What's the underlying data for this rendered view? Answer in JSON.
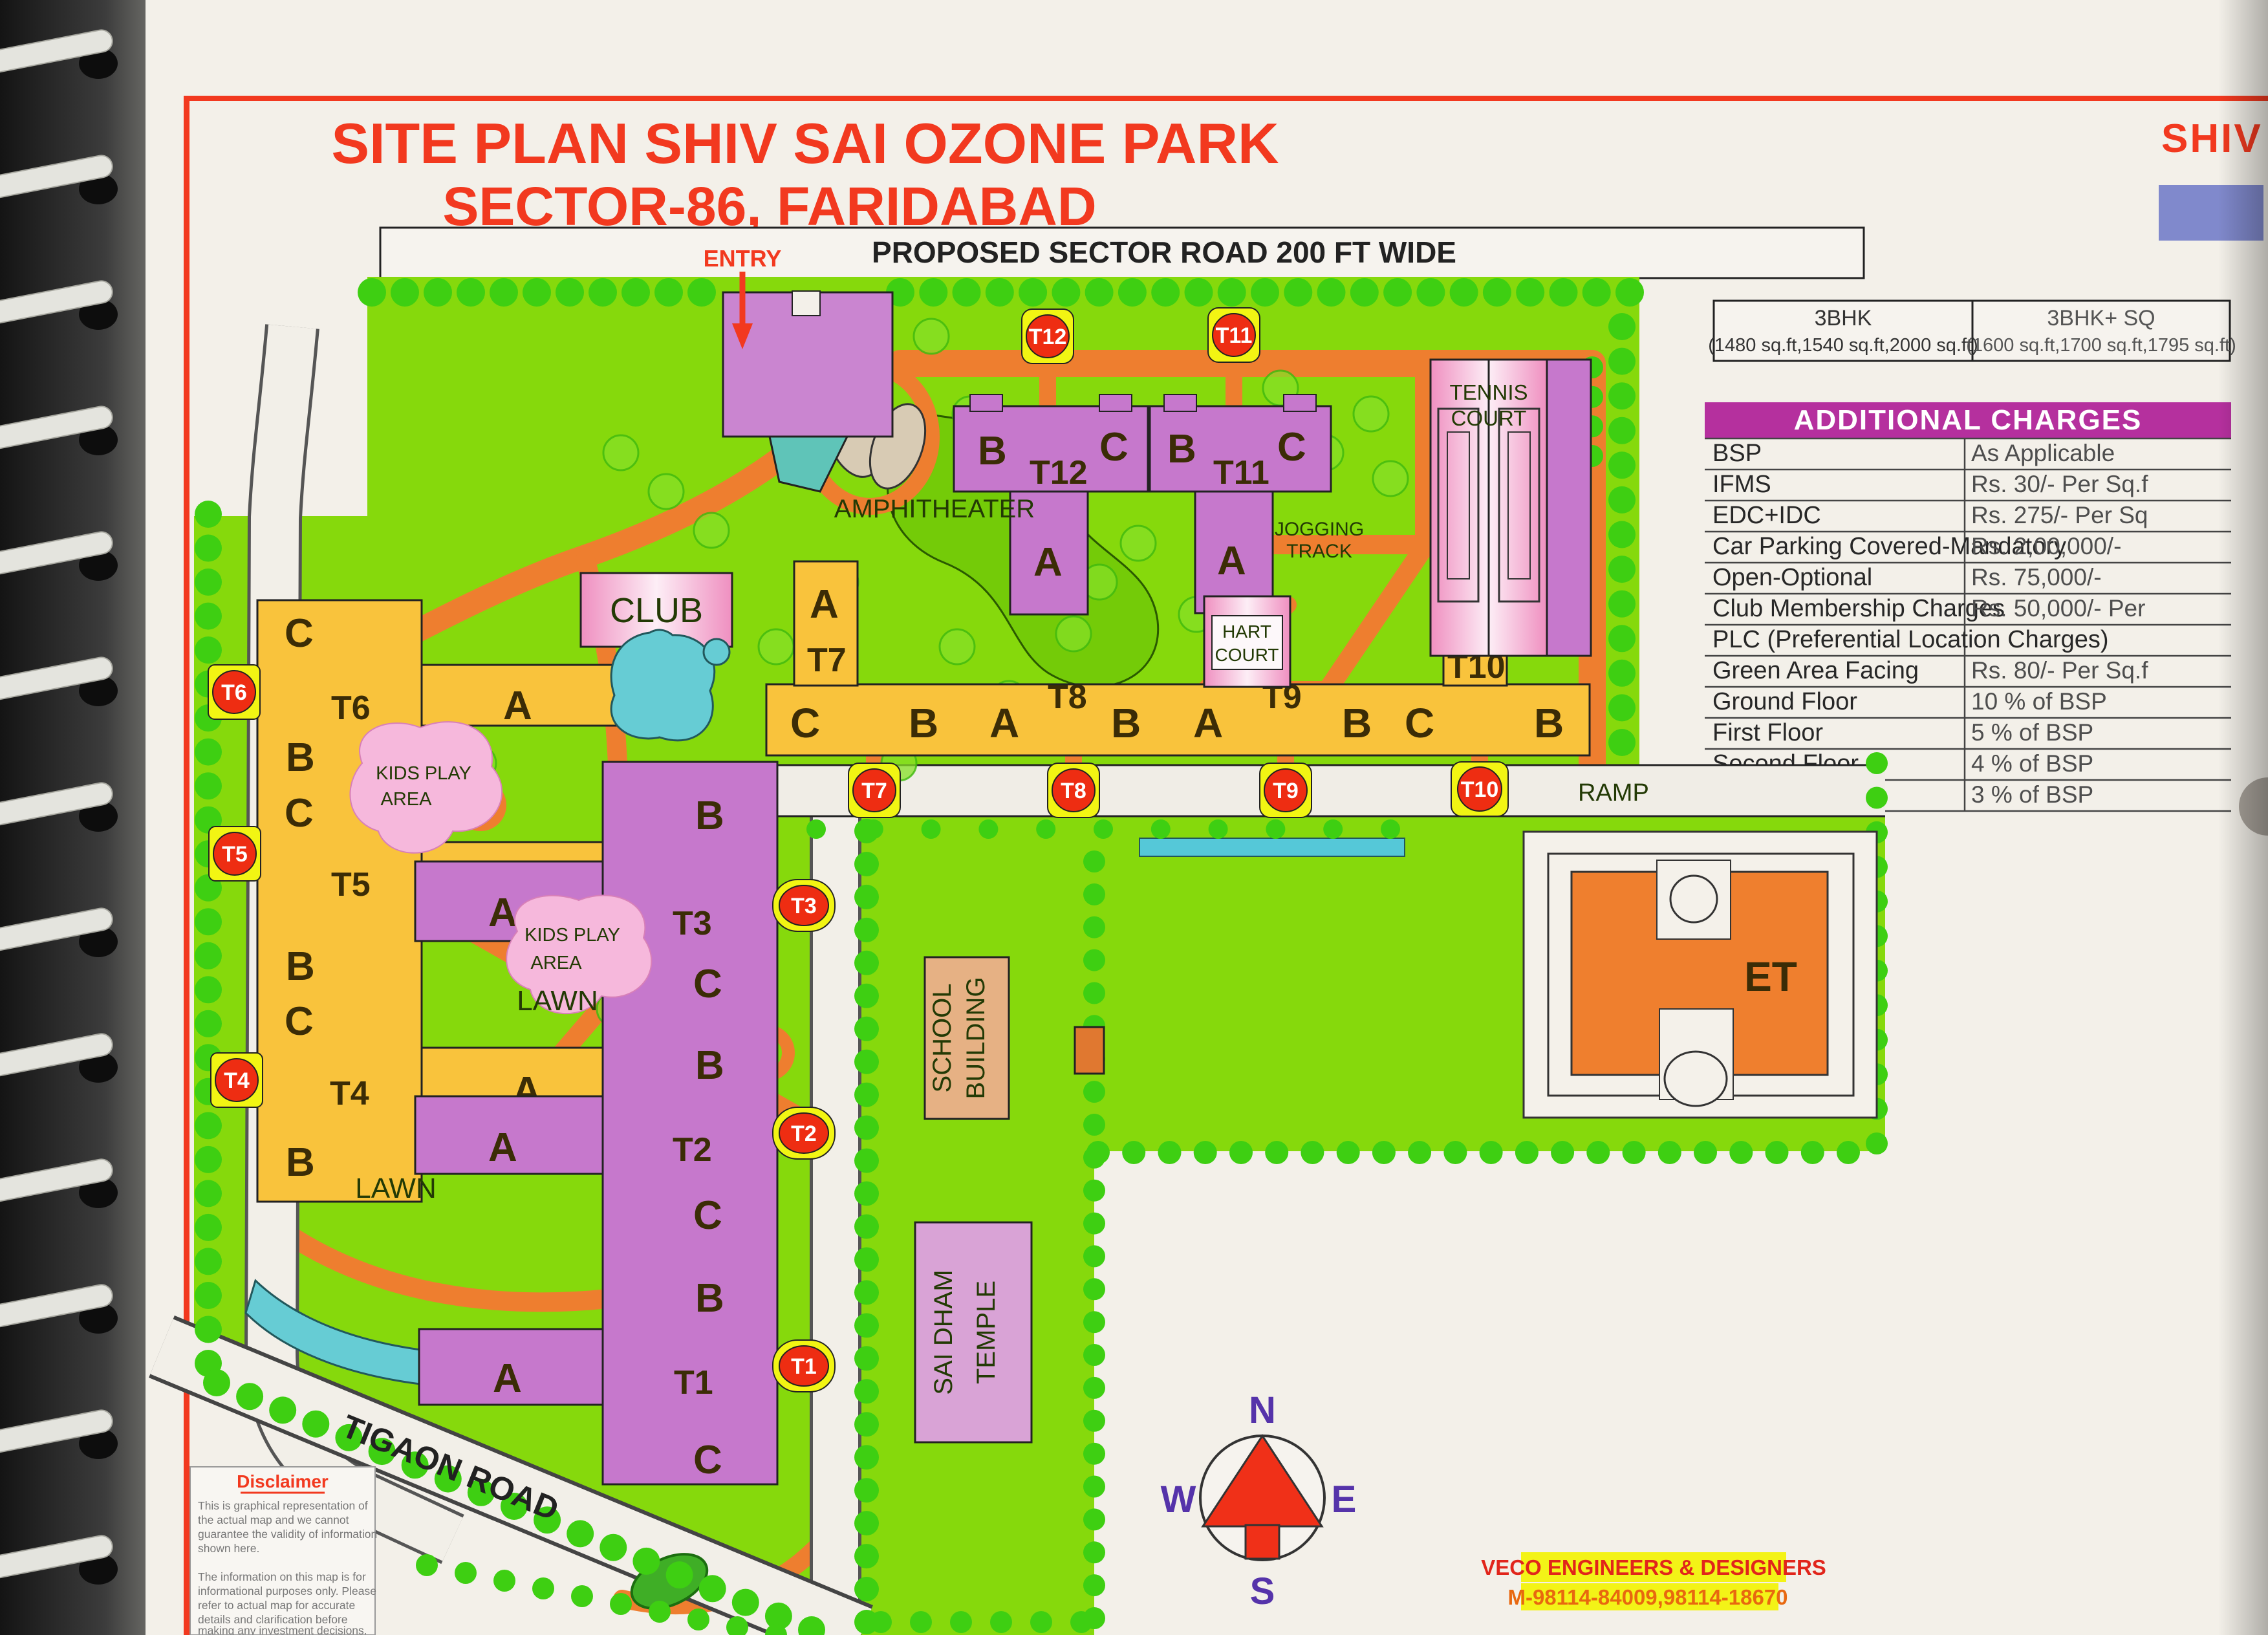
{
  "header": {
    "title_line1": "SITE PLAN SHIV SAI OZONE PARK",
    "title_line2": "SECTOR-86, FARIDABAD",
    "corner_logo": "SHIV S",
    "sector_road": "PROPOSED SECTOR ROAD 200 FT WIDE",
    "entry": "ENTRY"
  },
  "unit_table": {
    "col1_name": "3BHK",
    "col1_sizes": "(1480 sq.ft,1540 sq.ft,2000 sq.ft)",
    "col2_name": "3BHK+ SQ",
    "col2_sizes": "(1600 sq.ft,1700 sq.ft,1795 sq.ft)"
  },
  "charges": {
    "header": "ADDITIONAL CHARGES",
    "rows": [
      {
        "label": "BSP",
        "value": "As Applicable"
      },
      {
        "label": "IFMS",
        "value": "Rs. 30/- Per Sq.f"
      },
      {
        "label": "EDC+IDC",
        "value": "Rs. 275/- Per Sq"
      },
      {
        "label": "Car Parking Covered-Mandatory",
        "value": "Rs. 2,00,000/-"
      },
      {
        "label": "Open-Optional",
        "value": "Rs. 75,000/-"
      },
      {
        "label": "Club Membership Charges",
        "value": "Rs. 50,000/- Per"
      },
      {
        "label": "PLC (Preferential Location Charges)",
        "value": ""
      },
      {
        "label": "Green Area Facing",
        "value": "Rs. 80/- Per Sq.f"
      },
      {
        "label": "Ground Floor",
        "value": "10 % of BSP"
      },
      {
        "label": "First Floor",
        "value": "5 % of BSP"
      },
      {
        "label": "Second Floor",
        "value": "4 % of BSP"
      },
      {
        "label": "ThirdFloor",
        "value": "3 % of BSP"
      }
    ]
  },
  "markers": {
    "t1": "T1",
    "t2": "T2",
    "t3": "T3",
    "t4": "T4",
    "t5": "T5",
    "t6": "T6",
    "t7": "T7",
    "t8": "T8",
    "t9": "T9",
    "t10": "T10",
    "t11": "T11",
    "t12": "T12"
  },
  "map_letters": {
    "t12_l": "B",
    "t12_c": "T12",
    "t12_r": "C",
    "t12_a": "A",
    "t11_l": "B",
    "t11_c": "T11",
    "t11_r": "C",
    "t11_a": "A",
    "t7_a": "A",
    "t7": "T7",
    "r1": "C",
    "r2": "B",
    "r3": "A",
    "t8": "T8",
    "r4": "B",
    "r5": "A",
    "t9": "T9",
    "r6": "B",
    "r7": "C",
    "t10": "T10",
    "r8": "B",
    "t10_a": "A",
    "t6_top": "C",
    "t6": "T6",
    "t6_a": "A",
    "lc1": "B",
    "lc2": "C",
    "t5": "T5",
    "t5_a": "A",
    "lc3": "B",
    "lc4": "C",
    "t4": "T4",
    "t4_a": "A",
    "lc5": "B",
    "pc1": "B",
    "t3": "T3",
    "t3_a": "A",
    "pc2": "C",
    "pc3": "B",
    "t2": "T2",
    "t2_a": "A",
    "pc4": "C",
    "pc5": "B",
    "t1": "T1",
    "t1_a": "A",
    "pc6": "C"
  },
  "labels": {
    "club": "CLUB",
    "amphitheater": "AMPHITHEATER",
    "jogging_1": "JOGGING",
    "jogging_2": "TRACK",
    "hart_1": "HART",
    "hart_2": "COURT",
    "tennis_1": "TENNIS",
    "tennis_2": "COURT",
    "ramp": "RAMP",
    "school_1": "SCHOOL",
    "school_2": "BUILDING",
    "temple_1": "SAI DHAM",
    "temple_2": "TEMPLE",
    "et": "ET",
    "kids_play_1a": "KIDS PLAY",
    "kids_play_1b": "AREA",
    "kids_play_2a": "KIDS PLAY",
    "kids_play_2b": "AREA",
    "lawn_1": "LAWN",
    "lawn_2": "LAWN",
    "tigaon_road": "TIGAON ROAD"
  },
  "compass": {
    "n": "N",
    "e": "E",
    "s": "S",
    "w": "W"
  },
  "veco": {
    "line1": "VECO ENGINEERS & DESIGNERS",
    "line2": "M-98114-84009,98114-18670"
  },
  "disclaimer": {
    "heading": "Disclaimer",
    "lines": [
      "This is graphical representation of",
      "the actual map and we cannot",
      "guarantee the validity of information",
      "shown here.",
      "",
      "The information on this map is for",
      "informational purposes only. Please",
      "refer to actual map for accurate",
      "details and clarification before",
      "making any investment decisions."
    ]
  },
  "colors": {
    "map_green": "#86d90c",
    "road_orange": "#ee7e2f",
    "tower_purple": "#c678cc",
    "tower_yellow": "#f9c33c",
    "accent_red": "#f2391f",
    "marker_yellow": "#f2f513",
    "marker_red": "#ee2d12",
    "table_header_purple": "#b5309e",
    "water_cyan": "#66ccd4"
  }
}
